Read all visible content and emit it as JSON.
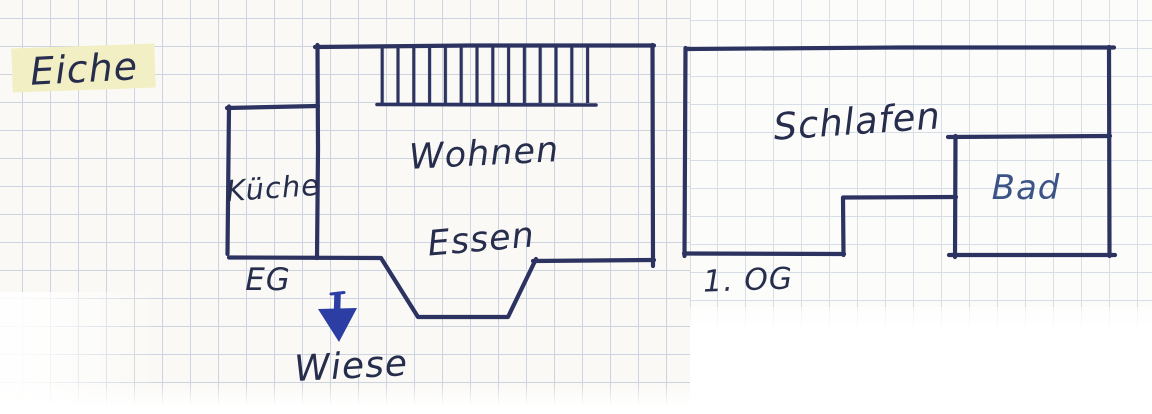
{
  "sketch": {
    "site_label": "Eiche",
    "ground_label": "Wiese",
    "arrow_direction": "down"
  },
  "floors": {
    "eg": {
      "label": "EG",
      "rooms": {
        "kitchen": "Küche",
        "living": "Wohnen",
        "dining": "Essen"
      },
      "features": {
        "stairs": "stairs-hatch",
        "bay": "dining-bay"
      }
    },
    "og": {
      "label": "1. OG",
      "rooms": {
        "sleeping": "Schlafen",
        "bath": "Bad"
      }
    }
  },
  "colors": {
    "ink": "#2c3360",
    "text-ink": "#272d4c",
    "light-ink": "#3c5388",
    "arrow": "#2c3ea4",
    "highlight": "#f2efc4",
    "grid": "#ccd4df",
    "grid-light": "#d8dee8",
    "paper": "#faf9f5",
    "paper-right": "#fcfcfa"
  }
}
